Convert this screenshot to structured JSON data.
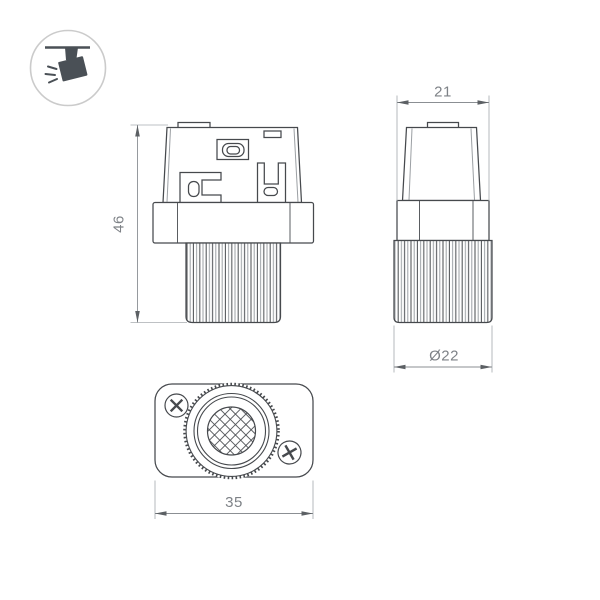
{
  "product_drawing": {
    "dims": {
      "height": "46",
      "top_width": "21",
      "diameter": "Ø22",
      "length": "35"
    },
    "icons": {
      "badge": "track-spotlight-icon"
    },
    "colors": {
      "outline": "#46494d",
      "dimension_line": "#8b8f93",
      "dimension_text": "#7e8287",
      "icon_fill": "#4a5056",
      "badge_ring": "#cbcbcb",
      "background": "#ffffff"
    }
  }
}
